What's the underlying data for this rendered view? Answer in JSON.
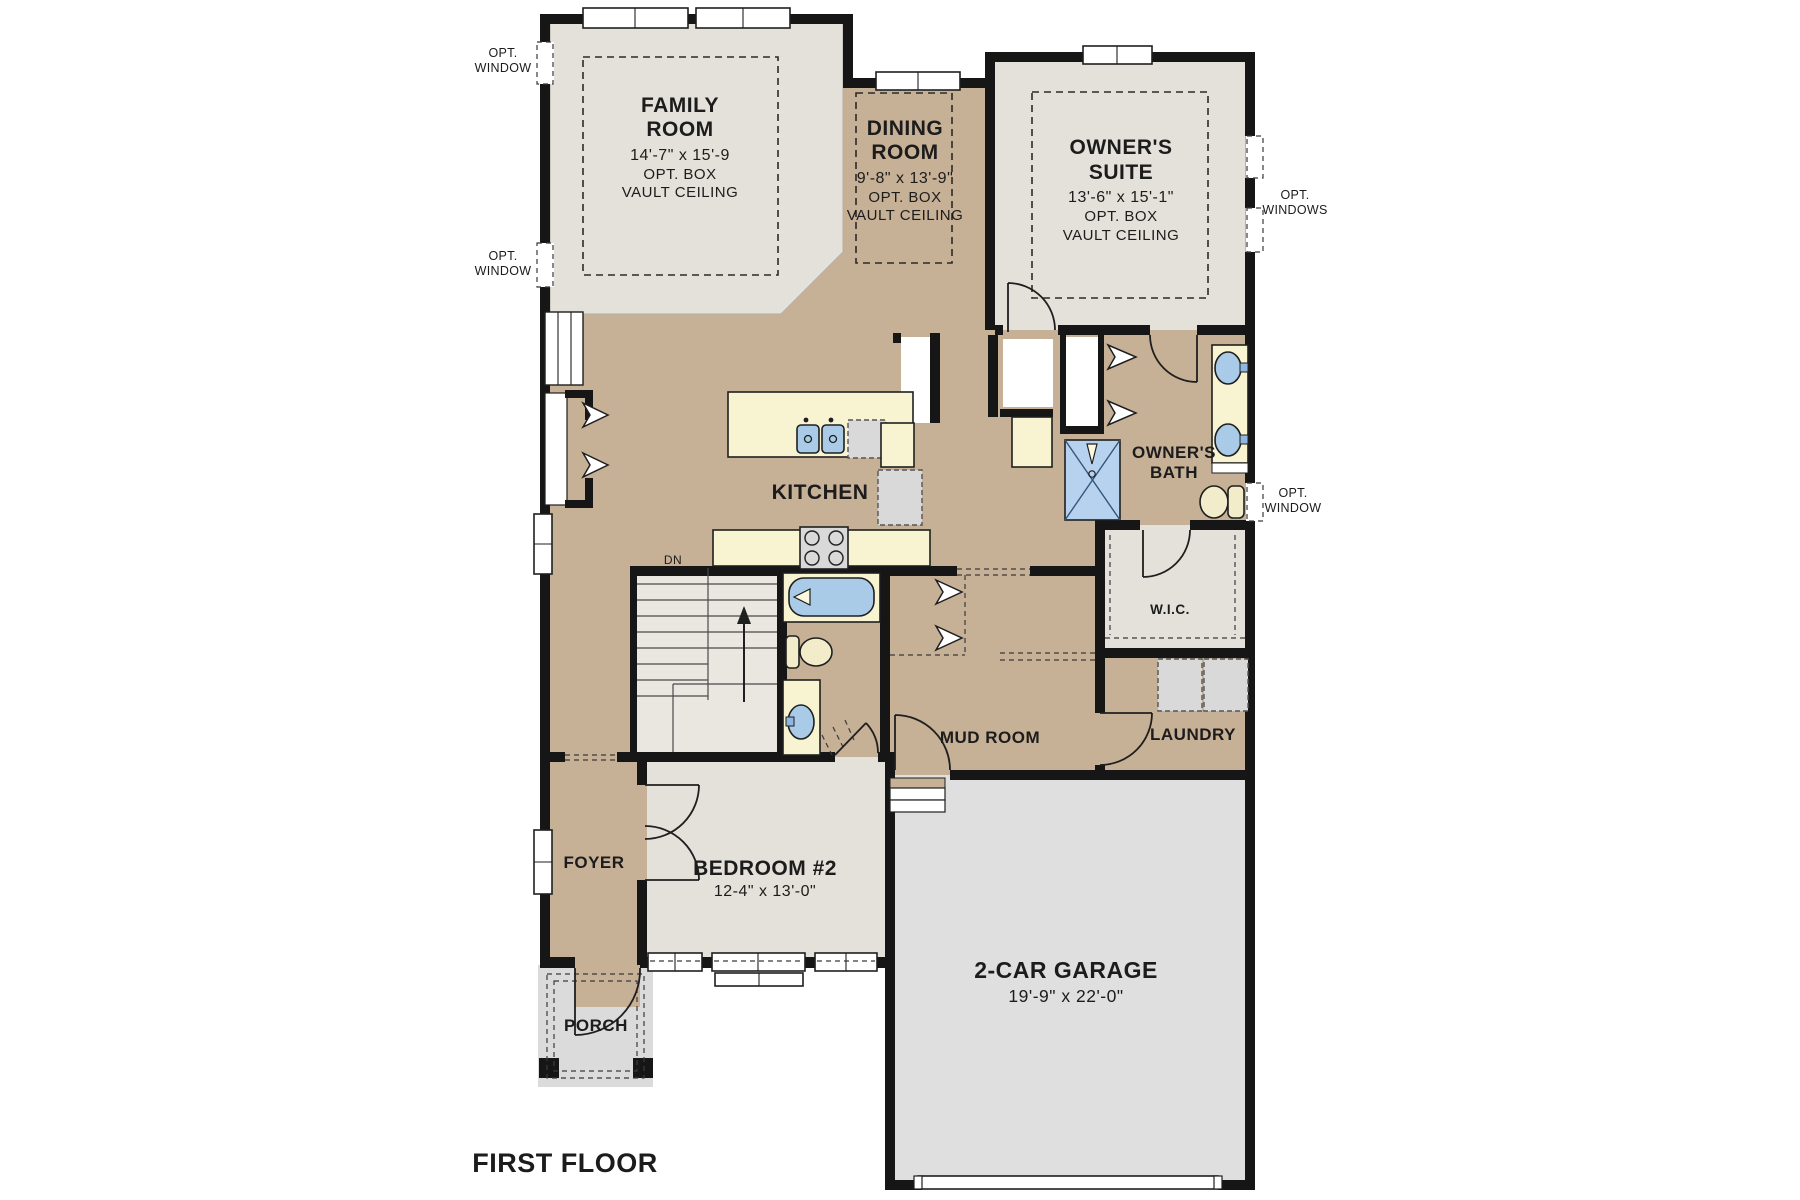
{
  "title": "FIRST FLOOR",
  "palette": {
    "wall_black": "#161616",
    "floor_tan": "#C6B096",
    "room_light_gray": "#E4E1DA",
    "counter_yellow": "#F8F4D2",
    "fixture_blue": "#A9CBE8",
    "garage_gray": "#DFDFDF",
    "porch_gray": "#DBDBDB",
    "toilet_cream": "#F3ECCB"
  },
  "rooms": {
    "family_room": {
      "lines": [
        "FAMILY",
        "ROOM",
        "14'-7\" x 15'-9",
        "OPT. BOX",
        "VAULT CEILING"
      ]
    },
    "dining_room": {
      "lines": [
        "DINING",
        "ROOM",
        "9'-8\" x 13'-9\"",
        "OPT. BOX",
        "VAULT CEILING"
      ]
    },
    "owners_suite": {
      "lines": [
        "OWNER'S",
        "SUITE",
        "13'-6\" x 15'-1\"",
        "OPT. BOX",
        "VAULT CEILING"
      ]
    },
    "kitchen": {
      "lines": [
        "KITCHEN"
      ]
    },
    "owners_bath": {
      "lines": [
        "OWNER'S",
        "BATH"
      ]
    },
    "wic": {
      "lines": [
        "W.I.C."
      ]
    },
    "mud_room": {
      "lines": [
        "MUD ROOM"
      ]
    },
    "laundry": {
      "lines": [
        "LAUNDRY"
      ]
    },
    "foyer": {
      "lines": [
        "FOYER"
      ]
    },
    "bedroom_2": {
      "lines": [
        "BEDROOM #2",
        "12-4\" x 13'-0\""
      ]
    },
    "porch": {
      "lines": [
        "PORCH"
      ]
    },
    "garage": {
      "lines": [
        "2-CAR GARAGE",
        "19'-9\" x 22'-0\""
      ]
    }
  },
  "annotations": {
    "opt_window_upper_left": {
      "lines": [
        "OPT.",
        "WINDOW"
      ]
    },
    "opt_window_lower_left": {
      "lines": [
        "OPT.",
        "WINDOW"
      ]
    },
    "opt_windows_right": {
      "lines": [
        "OPT.",
        "WINDOWS"
      ]
    },
    "opt_window_bath": {
      "lines": [
        "OPT.",
        "WINDOW"
      ]
    },
    "stair_direction": "DN"
  }
}
